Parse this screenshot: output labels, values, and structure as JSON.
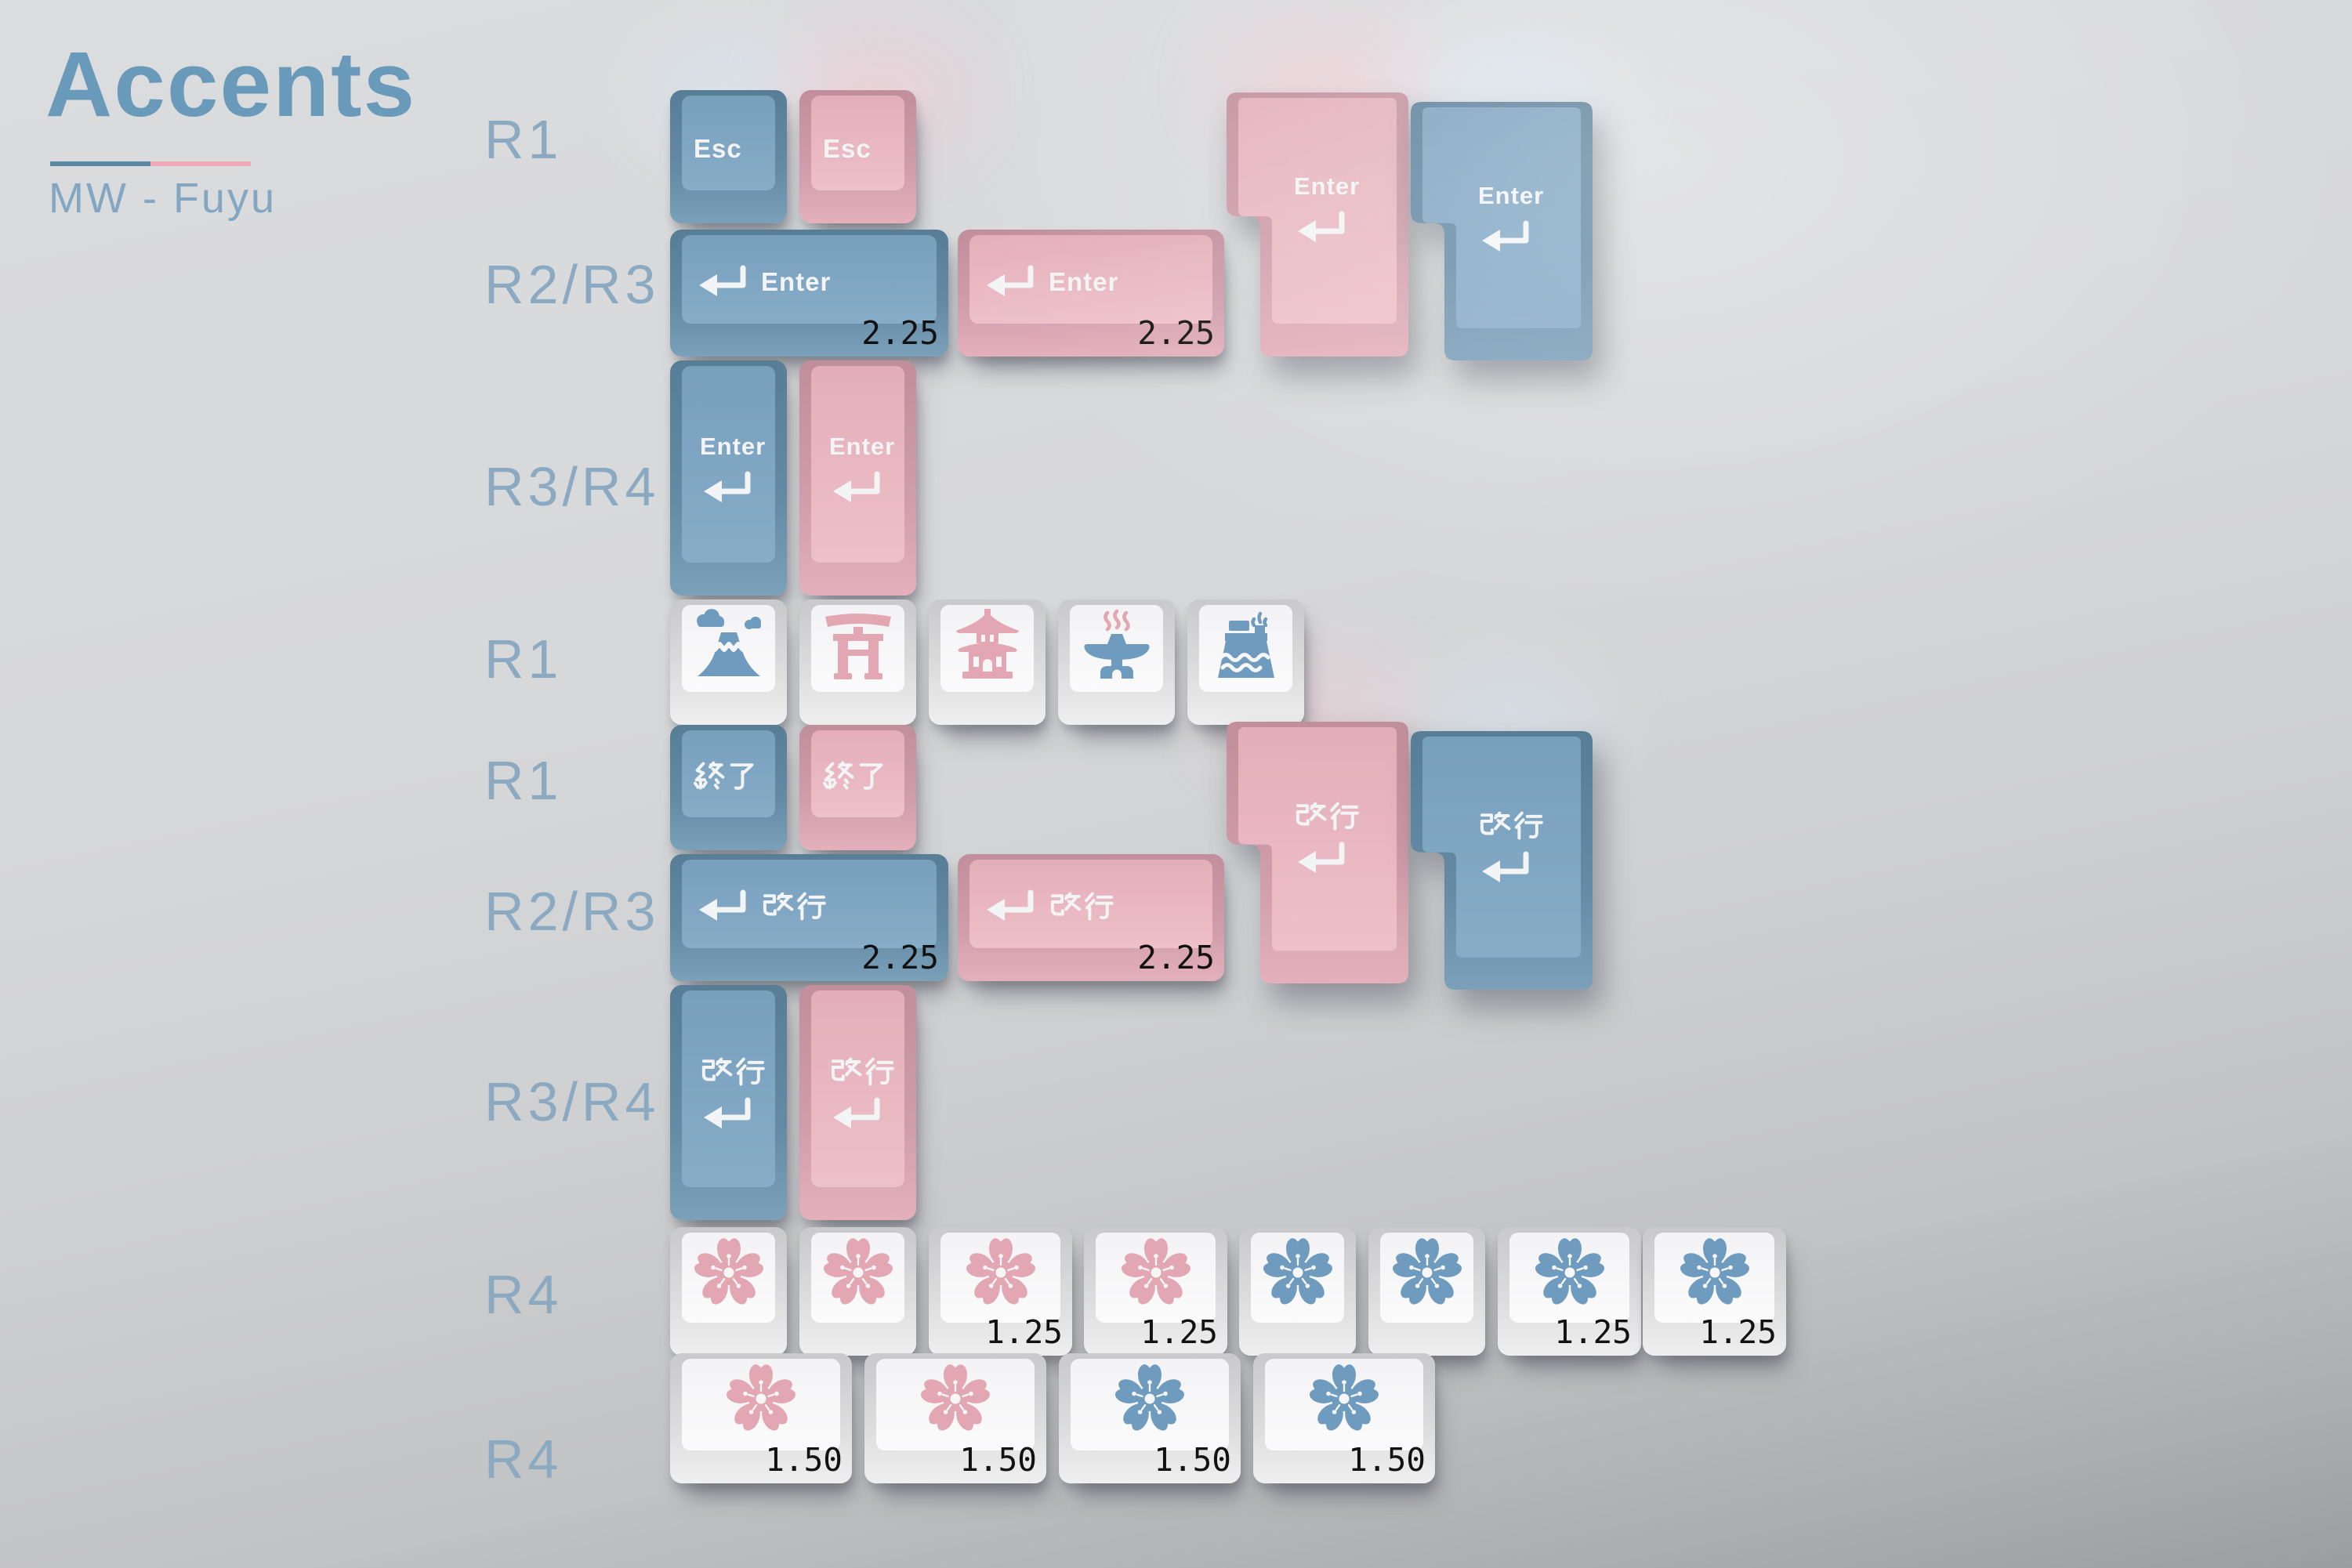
{
  "header": {
    "title": "Accents",
    "subtitle": "MW - Fuyu"
  },
  "rows": [
    {
      "label": "R1"
    },
    {
      "label": "R2/R3"
    },
    {
      "label": "R3/R4"
    },
    {
      "label": "R1"
    },
    {
      "label": "R1"
    },
    {
      "label": "R2/R3"
    },
    {
      "label": "R3/R4"
    },
    {
      "label": "R4"
    },
    {
      "label": "R4"
    }
  ],
  "legends": {
    "esc": "Esc",
    "enter": "Enter",
    "exit_jp": "終了",
    "linebreak_jp": "改行",
    "return_arrow": "↵"
  },
  "sizes": {
    "s225": "2.25",
    "s125": "1.25",
    "s150": "1.50"
  },
  "icons": {
    "novelties": [
      "volcano-icon",
      "torii-gate-icon",
      "pagoda-icon",
      "hot-spring-icon",
      "ferry-icon"
    ],
    "flower": "sakura-icon"
  },
  "colors": {
    "key_blue": "#6f96b3",
    "key_pink": "#e3aeb9",
    "key_white": "#f3f3f5",
    "legend_white": "#f2f4f5",
    "icon_blue": "#6f9cbe",
    "icon_pink": "#e2a7b3",
    "size_label": "#111111",
    "title_blue": "#699aba",
    "underline_blue": "#5c89a6",
    "underline_pink": "#efa9b6",
    "row_label_blue": "#8ba9c1"
  }
}
